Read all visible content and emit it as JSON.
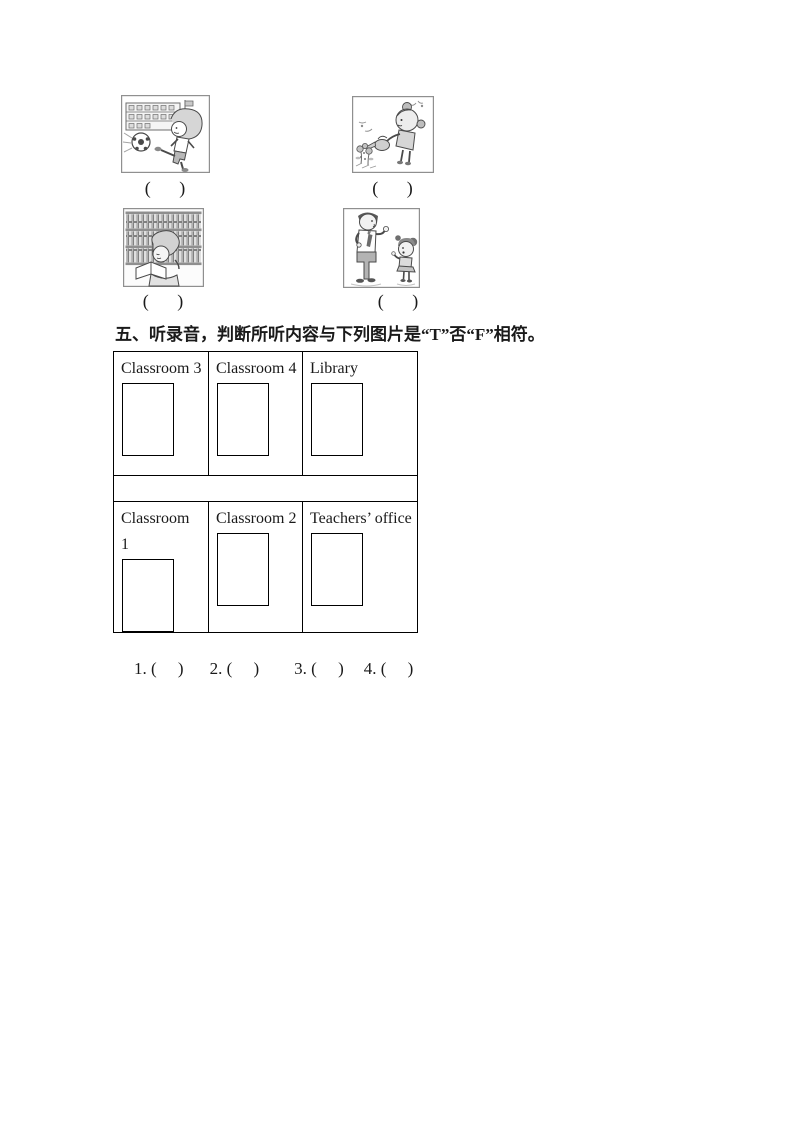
{
  "document": {
    "background": "#ffffff",
    "text_color": "#1a1a1a",
    "border_color": "#000000"
  },
  "pictures": {
    "items": [
      {
        "image": "boy-kicking-football-outside-school",
        "caption": "(     )"
      },
      {
        "image": "girl-watering-flowers",
        "caption": "(     )"
      },
      {
        "image": "girl-reading-in-library",
        "caption": "(     )"
      },
      {
        "image": "teacher-talking-with-pupil",
        "caption": "(     )"
      }
    ]
  },
  "section5": {
    "heading": "五、听录音，判断所听内容与下列图片是“T”否“F”相符。",
    "table": {
      "row1": [
        "Classroom 3",
        "Classroom 4",
        "Library"
      ],
      "row2": [
        "Classroom\n1",
        "Classroom 2",
        "Teachers’ office"
      ]
    },
    "answers": [
      "1. (     )",
      "2. (     )",
      "3. (     )",
      "4. (     )"
    ]
  }
}
